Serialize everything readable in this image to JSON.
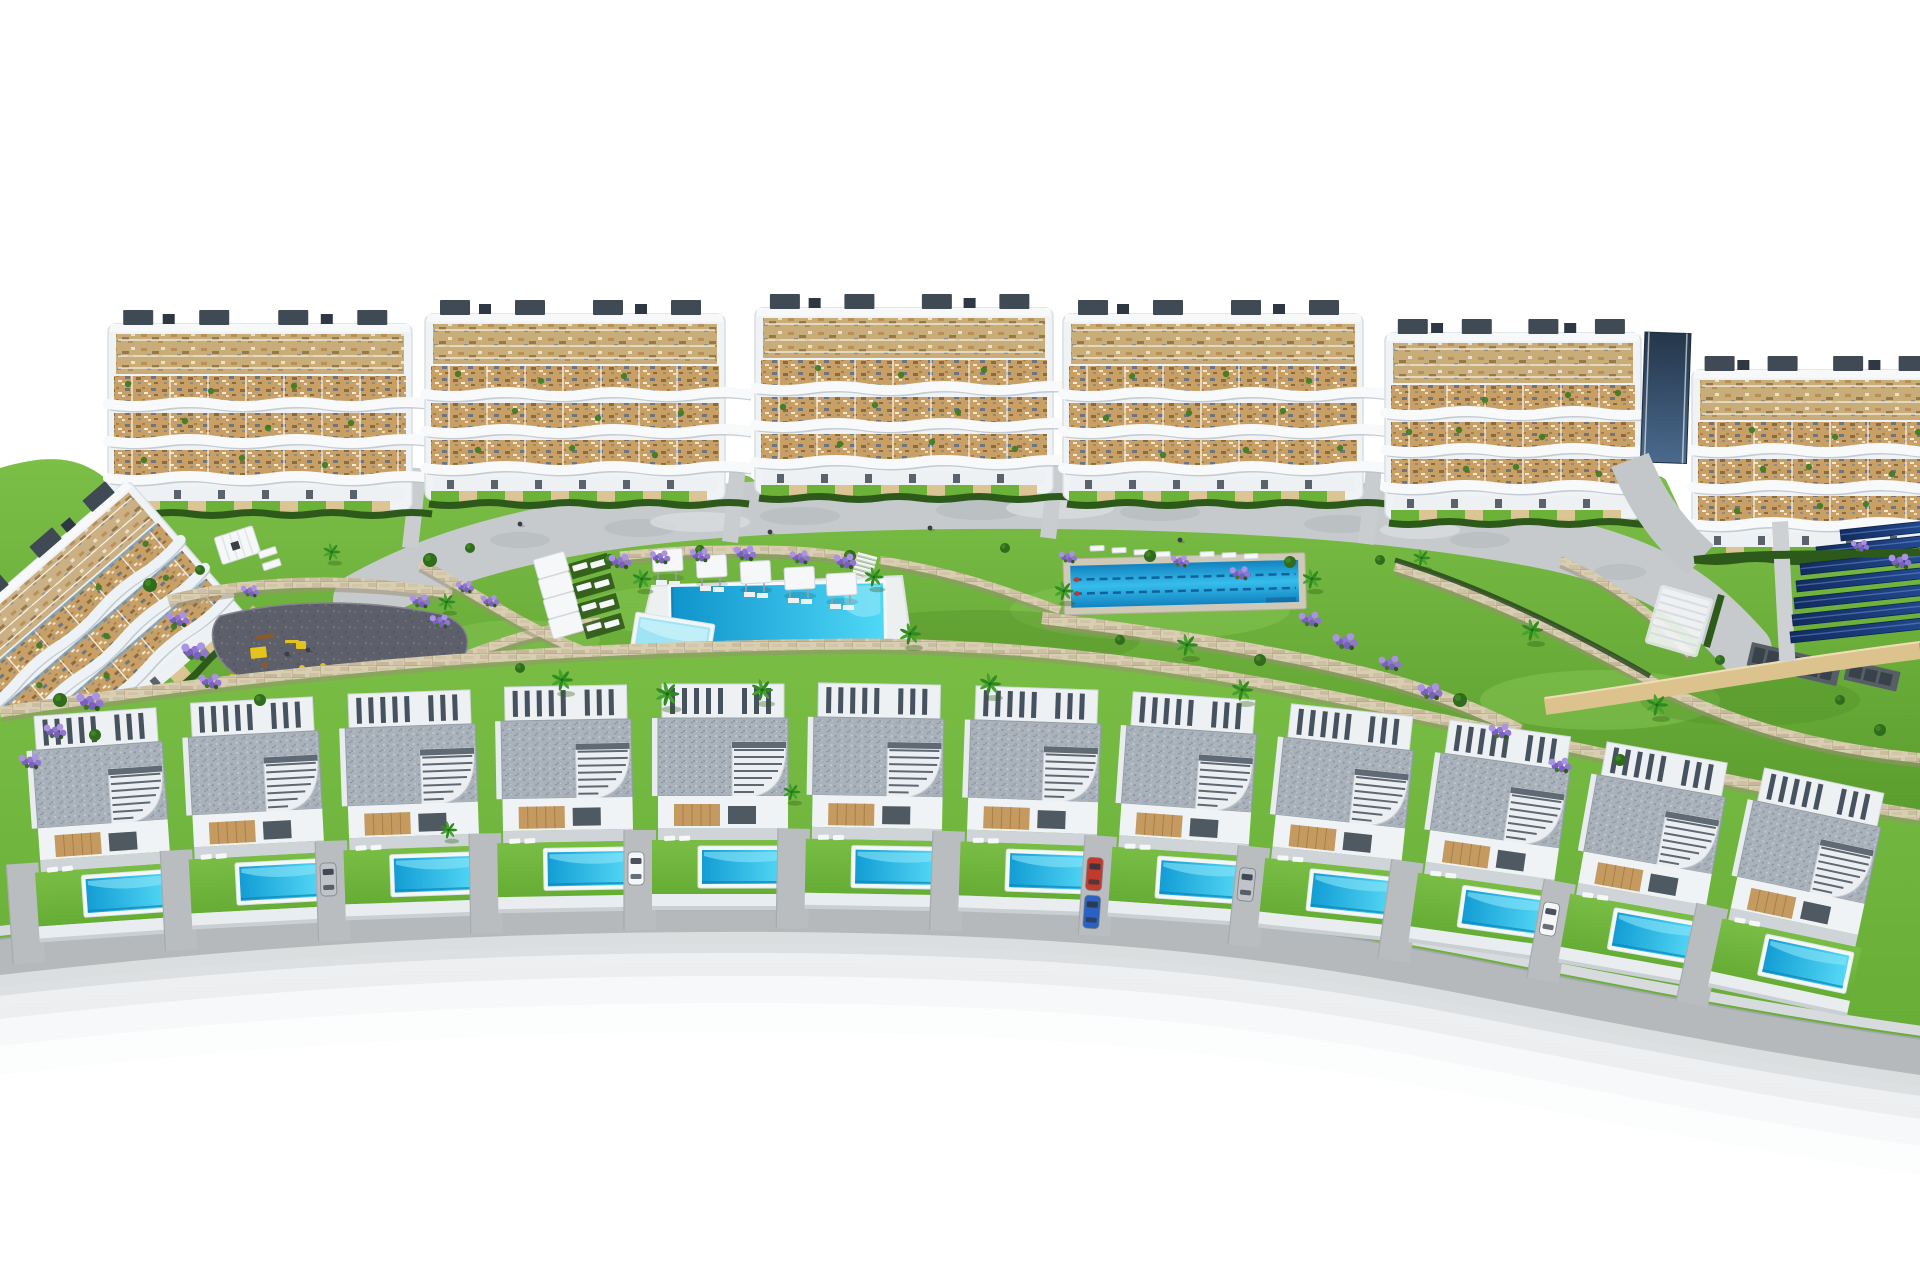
{
  "scene": {
    "kind": "aerial-3d-render-residential-development",
    "colors": {
      "sky": "#ffffff",
      "building_white": "#f0f3f5",
      "building_stroke": "#d9dfe3",
      "parapet": "#f6f8f9",
      "band_white": "#f7f9fa",
      "band_shadow": "#b9c2c9",
      "terrace_tan": "#c8a066",
      "deck_tan": "#c9ad79",
      "roof_box": "#3f4a55",
      "ground_floor": "#eef1f3",
      "door_dark": "#49535d",
      "hedge": "#2d5a1b",
      "lawn_light": "#7cbf47",
      "lawn_deep": "#5a9c2d",
      "villa_lawn_a": "#66ad35",
      "villa_lawn_b": "#79bd45",
      "promenade": "#c6cacc",
      "promenade_dark": "#b6bcbf",
      "promenade_light": "#d9dcde",
      "stone_base": "#d9cdb2",
      "stone_dark": "#a39878",
      "asphalt": "#5d5f6a",
      "play_yellow": "#e5c31f",
      "play_wood": "#8a5a2a",
      "lavender_a": "#9176cf",
      "lavender_b": "#ab92e3",
      "lavender_c": "#7b5fc0",
      "palm_green": "#2f8a1f",
      "palm_green2": "#45a22c",
      "trunk": "#7a5c38",
      "bush": "#316b1d",
      "pool_deep": "#0f93cc",
      "pool_bright": "#4fd8f6",
      "pool_pale": "#9fe4f4",
      "lap_deep": "#1283c0",
      "lap_bright": "#36bdec",
      "lap_rim": "#cfc9b8",
      "lane_rope": "#0e5b95",
      "rope_red": "#c0392b",
      "villa_roof": "#a9b2ba",
      "villa_white": "#eef1f4",
      "slat_dark": "#46525e",
      "wood_wall": "#c49a60",
      "wood_grain": "#a87f48",
      "stair_step": "#5e6872",
      "road": "#b5b9bc",
      "road_edge": "#9fa5a9",
      "sidewalk": "#d8dbdd",
      "driveway": "#b9bdc0",
      "sand": "#dcc28c",
      "solar_dark": "#122c5e",
      "solar_light": "#2b57a8",
      "ramp_dark": "#24364a",
      "ramp_light": "#4a6a8e",
      "glass_blue": "#7ca6c6",
      "gray_platform": "#565e66",
      "gray_lounger": "#39424a",
      "white_furn": "#f5f7f8",
      "car_white": "#f4f6f8",
      "car_silver": "#c0c4c8",
      "car_red": "#c03a2e",
      "car_blue": "#2a62c4",
      "people": "#3b3e44"
    },
    "apartment_blocks": [
      {
        "x": 108,
        "top": 302,
        "width": 304,
        "phase": 0
      },
      {
        "x": 425,
        "top": 292,
        "width": 300,
        "phase": 21
      },
      {
        "x": 755,
        "top": 286,
        "width": 298,
        "phase": 43
      },
      {
        "x": 1063,
        "top": 292,
        "width": 300,
        "phase": 11
      },
      {
        "x": 1385,
        "top": 311,
        "width": 256,
        "phase": 33
      },
      {
        "x": 1692,
        "top": 348,
        "width": 252,
        "phase": 52
      }
    ],
    "left_building": {
      "tx": -90,
      "ty": 640,
      "rotate": -41,
      "width": 270
    },
    "ramp": {
      "x": 1645,
      "y": 332,
      "w": 46,
      "h": 130
    },
    "gap_paths": [
      {
        "x": 418,
        "y": 468
      },
      {
        "x": 738,
        "y": 462
      },
      {
        "x": 1056,
        "y": 458
      },
      {
        "x": 1374,
        "y": 464
      }
    ],
    "garden_base_path": "M0,468 C60,450 90,460 120,492 L415,498 C420,480 424,478 430,488 L725,488 C733,472 748,472 756,482 L1050,482 C1056,472 1062,474 1066,486 L1358,488 C1366,478 1378,482 1388,502 L1638,505 C1646,480 1656,470 1666,480 L1694,540 L1920,548 L1920,830 L1700,780 L1450,728 L1250,690 L1050,658 L850,645 L650,648 L450,662 L250,690 L0,718 Z",
    "promenade_path": "M360,600 C500,520 700,505 960,502 C1220,500 1420,515 1560,545 C1660,568 1700,600 1745,650",
    "promenade_blotches_dark": [
      [
        520,
        540,
        30,
        8
      ],
      [
        640,
        528,
        36,
        9
      ],
      [
        800,
        516,
        40,
        9
      ],
      [
        980,
        510,
        44,
        10
      ],
      [
        1160,
        512,
        40,
        9
      ],
      [
        1340,
        524,
        36,
        9
      ],
      [
        1480,
        540,
        30,
        8
      ],
      [
        1620,
        572,
        26,
        8
      ]
    ],
    "promenade_blotches_light": [
      [
        700,
        522,
        50,
        10
      ],
      [
        1060,
        508,
        54,
        11
      ],
      [
        1420,
        530,
        40,
        9
      ]
    ],
    "lawn_patches_light": [
      [
        700,
        610,
        120,
        26
      ],
      [
        1150,
        610,
        140,
        30
      ],
      [
        520,
        640,
        80,
        20
      ],
      [
        1600,
        700,
        120,
        30
      ]
    ],
    "lawn_patches_dark": [
      [
        980,
        640,
        160,
        30
      ],
      [
        300,
        640,
        100,
        24
      ],
      [
        1750,
        700,
        110,
        26
      ]
    ],
    "walls": [
      {
        "d": "M168,600 C250,580 350,576 452,594",
        "w": 10
      },
      {
        "d": "M210,698 C300,706 390,688 455,660 C500,642 540,628 600,622",
        "w": 9
      },
      {
        "d": "M420,563 C470,590 520,625 580,650 C620,662 660,658 690,655",
        "w": 10
      },
      {
        "d": "M620,556 C720,546 800,548 858,558",
        "w": 9
      },
      {
        "d": "M880,560 C960,572 1020,596 1060,610",
        "w": 8
      },
      {
        "d": "M1042,618 C1140,630 1260,648 1360,672 C1420,686 1470,706 1520,730",
        "w": 12
      },
      {
        "d": "M1180,668 C1280,684 1380,710 1470,742",
        "w": 10
      },
      {
        "d": "M1395,566 C1490,596 1580,640 1660,686 C1740,726 1820,748 1920,758",
        "w": 10
      },
      {
        "d": "M1560,560 C1620,586 1660,620 1690,655",
        "w": 8
      },
      {
        "d": "M0,730 C60,716 110,706 168,700",
        "w": 9
      }
    ],
    "canal_path": "M1395,560 C1480,586 1570,630 1650,676",
    "boundary_wall_path": "M0,712 C300,666 560,646 860,644 C1120,644 1320,694 1520,736 C1700,774 1820,800 1920,815",
    "villa_band_path": "M0,712 C300,666 560,646 860,644 C1120,644 1320,694 1520,736 C1700,774 1820,800 1920,815 L1920,1075 C1750,1042 1500,990 1300,956 C1050,928 850,922 650,926 C400,934 150,948 0,962 Z",
    "stairs": {
      "x": 858,
      "y": 552,
      "rot": 15,
      "steps": 6
    },
    "main_pool": {
      "deck": "M640,636 L652,586 L902,576 L912,648 L846,666 L716,676 Z",
      "x": 668,
      "y": 584,
      "w": 218,
      "h": 68,
      "rot": -1
    },
    "kids_pool": {
      "x": 636,
      "y": 612,
      "w": 80,
      "h": 58,
      "rot": 9
    },
    "lap_pool": {
      "x": 1063,
      "y": 559,
      "w": 242,
      "h": 56,
      "rot": -1.5,
      "lanes": 2
    },
    "lap_loungers": [
      [
        1090,
        546
      ],
      [
        1112,
        548
      ],
      [
        1134,
        550
      ],
      [
        1156,
        552
      ],
      [
        1200,
        552
      ],
      [
        1222,
        553
      ],
      [
        1244,
        554
      ]
    ],
    "parasol_row": [
      [
        652,
        550
      ],
      [
        696,
        556
      ],
      [
        740,
        562
      ],
      [
        784,
        568
      ],
      [
        826,
        574
      ]
    ],
    "canopy_column": [
      [
        533,
        560
      ],
      [
        538,
        580
      ],
      [
        543,
        600
      ],
      [
        548,
        620
      ]
    ],
    "mat_loungers": [
      [
        572,
        566
      ],
      [
        576,
        586
      ],
      [
        581,
        606
      ],
      [
        586,
        626
      ]
    ],
    "small_pergola": {
      "x": 214,
      "y": 538,
      "rot": -18
    },
    "garden_loungers": [
      [
        258,
        552
      ],
      [
        262,
        564
      ]
    ],
    "right_pergola": {
      "x": 1662,
      "y": 586,
      "rot": 16
    },
    "right_fence": {
      "x": 1718,
      "y": 594,
      "rot": 16
    },
    "gray_platforms": [
      {
        "x": 1752,
        "y": 642,
        "w": 92,
        "h": 24,
        "rot": 13,
        "count": 6
      },
      {
        "x": 1848,
        "y": 660,
        "w": 54,
        "h": 20,
        "rot": 13,
        "count": 3
      }
    ],
    "sand_path": "M1545,706 C1660,690 1780,668 1920,650",
    "solar": {
      "strip": [
        1772,
        522,
        16,
        140
      ],
      "rows": [
        [
          1840,
          530,
          90
        ],
        [
          1816,
          547,
          120
        ],
        [
          1800,
          564,
          140
        ],
        [
          1796,
          581,
          152
        ],
        [
          1794,
          598,
          162
        ],
        [
          1792,
          615,
          170
        ],
        [
          1790,
          632,
          176
        ]
      ]
    },
    "b6_hedge": "M1694,560 C1760,552 1840,556 1920,552",
    "playground": {
      "pad": "M220,616 C280,600 360,598 440,614 C466,622 474,640 462,660 C440,690 380,702 320,700 C268,698 228,678 216,652 C210,636 212,624 220,616 Z",
      "items": [
        {
          "t": "rect",
          "x": 256,
          "y": 636,
          "w": 18,
          "h": 4,
          "c": "play_wood",
          "rot": -8
        },
        {
          "t": "rect",
          "x": 250,
          "y": 648,
          "w": 16,
          "h": 11,
          "c": "play_yellow",
          "rot": -6
        },
        {
          "t": "rect",
          "x": 285,
          "y": 640,
          "w": 14,
          "h": 3,
          "c": "play_yellow",
          "rot": 0
        },
        {
          "t": "rect",
          "x": 230,
          "y": 674,
          "w": 13,
          "h": 9,
          "c": "play_yellow",
          "rot": 5
        },
        {
          "t": "rect",
          "x": 296,
          "y": 641,
          "w": 10,
          "h": 8,
          "c": "play_yellow",
          "rot": 0
        },
        {
          "t": "dot",
          "x": 302,
          "y": 668,
          "r": 3,
          "c": "play_yellow"
        },
        {
          "t": "dot",
          "x": 313,
          "y": 671,
          "r": 3,
          "c": "play_yellow"
        },
        {
          "t": "dot",
          "x": 323,
          "y": 666,
          "r": 3,
          "c": "play_yellow"
        },
        {
          "t": "dot",
          "x": 265,
          "y": 665,
          "r": 3,
          "c": "play_wood"
        }
      ]
    },
    "villas": [
      {
        "cx": 97,
        "top": 712,
        "rot": -4,
        "cars": []
      },
      {
        "cx": 253,
        "top": 700,
        "rot": -3,
        "cars": []
      },
      {
        "cx": 410,
        "top": 692,
        "rot": -2,
        "cars": [
          "car_silver"
        ]
      },
      {
        "cx": 566,
        "top": 686,
        "rot": -1,
        "cars": []
      },
      {
        "cx": 723,
        "top": 684,
        "rot": 0,
        "cars": [
          "car_white"
        ]
      },
      {
        "cx": 879,
        "top": 684,
        "rot": 1,
        "cars": []
      },
      {
        "cx": 1036,
        "top": 688,
        "rot": 2,
        "cars": []
      },
      {
        "cx": 1192,
        "top": 696,
        "rot": 4,
        "cars": [
          "car_red",
          "car_blue"
        ]
      },
      {
        "cx": 1349,
        "top": 710,
        "rot": 6,
        "cars": [
          "car_silver"
        ]
      },
      {
        "cx": 1506,
        "top": 728,
        "rot": 8,
        "cars": []
      },
      {
        "cx": 1662,
        "top": 752,
        "rot": 10,
        "cars": [
          "car_white"
        ]
      },
      {
        "cx": 1818,
        "top": 780,
        "rot": 12,
        "cars": []
      }
    ],
    "road": {
      "d": "M-10,958 C250,928 500,912 780,914 C1060,916 1260,936 1460,975 C1620,1006 1780,1038 1930,1058",
      "d_edge": "M-10,940 C250,910 500,894 780,896 C1060,898 1260,918 1460,957 C1620,988 1780,1020 1930,1040",
      "d_walk": "M-10,932 C250,902 500,886 780,888 C1060,890 1260,910 1460,949 C1620,980 1780,1012 1930,1032",
      "shadows": [
        [
          24,
          30,
          "#ccd0d2",
          0.7
        ],
        [
          46,
          32,
          "#dfe2e4",
          0.55
        ],
        [
          70,
          38,
          "#eceef0",
          0.4
        ],
        [
          96,
          44,
          "#f6f7f8",
          0.3
        ]
      ]
    },
    "palms": [
      [
        560,
        690,
        1
      ],
      [
        640,
        588,
        0.9
      ],
      [
        665,
        705,
        1.1
      ],
      [
        760,
        700,
        1
      ],
      [
        872,
        586,
        0.9
      ],
      [
        908,
        644,
        1
      ],
      [
        988,
        694,
        1
      ],
      [
        1062,
        600,
        0.9
      ],
      [
        1185,
        655,
        1
      ],
      [
        1240,
        700,
        1
      ],
      [
        1310,
        588,
        0.9
      ],
      [
        1420,
        566,
        0.8
      ],
      [
        1530,
        640,
        1
      ],
      [
        1655,
        715,
        1
      ],
      [
        330,
        560,
        0.8
      ],
      [
        445,
        610,
        0.8
      ],
      [
        447,
        838,
        0.8
      ],
      [
        790,
        800,
        0.8
      ]
    ],
    "bushes": [
      [
        430,
        560,
        7
      ],
      [
        470,
        548,
        5
      ],
      [
        610,
        560,
        6
      ],
      [
        700,
        550,
        5
      ],
      [
        850,
        556,
        6
      ],
      [
        1005,
        548,
        5
      ],
      [
        1150,
        556,
        6
      ],
      [
        1290,
        562,
        6
      ],
      [
        1380,
        560,
        5
      ],
      [
        150,
        585,
        7
      ],
      [
        200,
        570,
        5
      ],
      [
        260,
        700,
        6
      ],
      [
        520,
        668,
        5
      ],
      [
        1460,
        700,
        7
      ],
      [
        1620,
        760,
        6
      ],
      [
        1720,
        660,
        5
      ],
      [
        60,
        700,
        7
      ],
      [
        95,
        735,
        6
      ],
      [
        1840,
        700,
        5
      ],
      [
        1880,
        730,
        6
      ],
      [
        1120,
        640,
        5
      ],
      [
        1260,
        660,
        6
      ]
    ],
    "lavender": [
      [
        178,
        618,
        1
      ],
      [
        195,
        650,
        1.2
      ],
      [
        210,
        680,
        1
      ],
      [
        90,
        700,
        1.2
      ],
      [
        55,
        730,
        1
      ],
      [
        620,
        560,
        1
      ],
      [
        660,
        556,
        0.9
      ],
      [
        700,
        554,
        0.9
      ],
      [
        745,
        552,
        1
      ],
      [
        800,
        556,
        0.9
      ],
      [
        845,
        560,
        1
      ],
      [
        1310,
        618,
        1
      ],
      [
        1345,
        640,
        1.1
      ],
      [
        1390,
        662,
        1
      ],
      [
        1430,
        690,
        1.1
      ],
      [
        1500,
        730,
        1
      ],
      [
        1560,
        764,
        1
      ],
      [
        420,
        600,
        0.9
      ],
      [
        465,
        586,
        0.8
      ],
      [
        1180,
        560,
        0.8
      ],
      [
        1240,
        572,
        0.9
      ],
      [
        1068,
        556,
        0.8
      ],
      [
        1900,
        560,
        1
      ],
      [
        1860,
        545,
        0.8
      ],
      [
        30,
        760,
        1
      ],
      [
        250,
        590,
        0.8
      ],
      [
        440,
        620,
        0.9
      ],
      [
        490,
        600,
        0.8
      ]
    ],
    "people": [
      [
        287,
        654
      ],
      [
        308,
        650
      ],
      [
        520,
        524
      ],
      [
        770,
        532
      ],
      [
        930,
        528
      ],
      [
        1180,
        540
      ]
    ]
  }
}
